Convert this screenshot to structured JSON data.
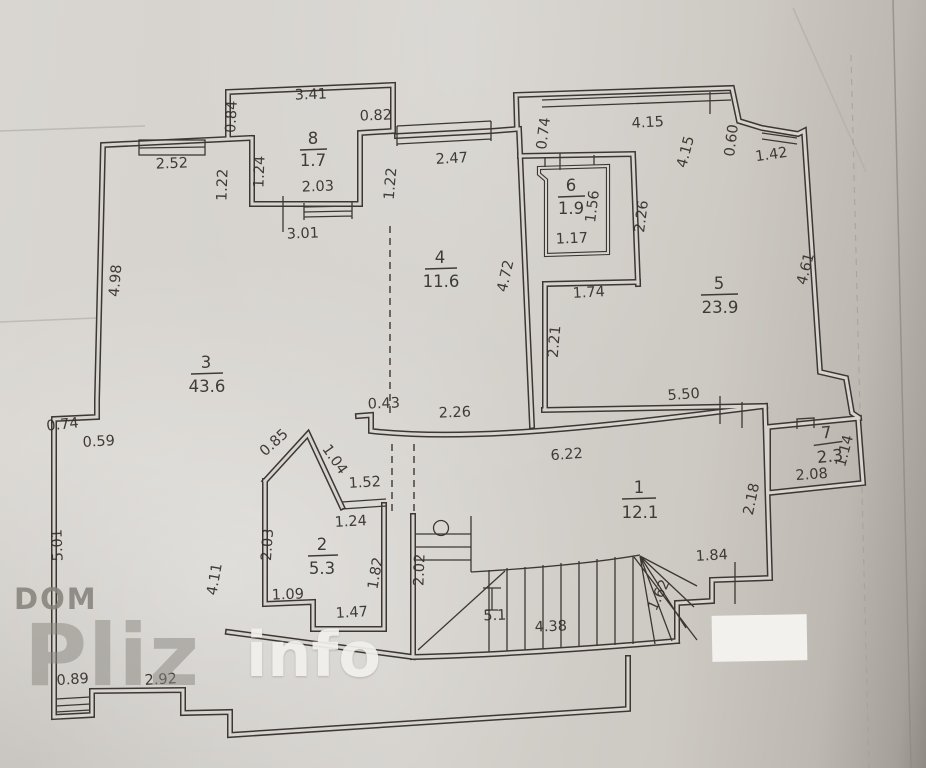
{
  "plan": {
    "rooms": {
      "r1": {
        "num": "1",
        "area": "12.1"
      },
      "r2": {
        "num": "2",
        "area": "5.3"
      },
      "r3": {
        "num": "3",
        "area": "43.6"
      },
      "r4": {
        "num": "4",
        "area": "11.6"
      },
      "r5": {
        "num": "5",
        "area": "23.9"
      },
      "r6": {
        "num": "6",
        "area": "1.9"
      },
      "r7": {
        "num": "7",
        "area": "2.3"
      },
      "r8": {
        "num": "8",
        "area": "1.7"
      }
    },
    "dims": {
      "d084": "0.84",
      "d341": "3.41",
      "d082": "0.82",
      "d252": "2.52",
      "d122a": "1.22",
      "d124a": "1.24",
      "d203a": "2.03",
      "d301": "3.01",
      "d122b": "1.22",
      "d247": "2.47",
      "d074a": "0.74",
      "d415a": "4.15",
      "d415b": "4.15",
      "d060": "0.60",
      "d142": "1.42",
      "d156": "1.56",
      "d117": "1.17",
      "d226a": "2.26",
      "d174": "1.74",
      "d472": "4.72",
      "d461": "4.61",
      "d221": "2.21",
      "d498": "4.98",
      "d550": "5.50",
      "d043": "0.43",
      "d226b": "2.26",
      "d622": "6.22",
      "d074b": "0.74",
      "d059": "0.59",
      "d501": "5.01",
      "d411": "4.11",
      "d085": "0.85",
      "d104": "1.04",
      "d152": "1.52",
      "d124b": "1.24",
      "d203b": "2.03",
      "d109": "1.09",
      "d147": "1.47",
      "d182": "1.82",
      "d114": "1.14",
      "d208": "2.08",
      "d218": "2.18",
      "d184": "1.84",
      "d202": "2.02",
      "d51": "5.1",
      "d438": "4.38",
      "d162": "1.62",
      "d089": "0.89",
      "d292": "2.92"
    },
    "watermark": {
      "top": "DOM",
      "big": "Pliz",
      "suffix": "info"
    },
    "colors": {
      "paper": "#d4d1cc",
      "ink": "#3c3732",
      "patch": "#f4f3f0"
    }
  }
}
